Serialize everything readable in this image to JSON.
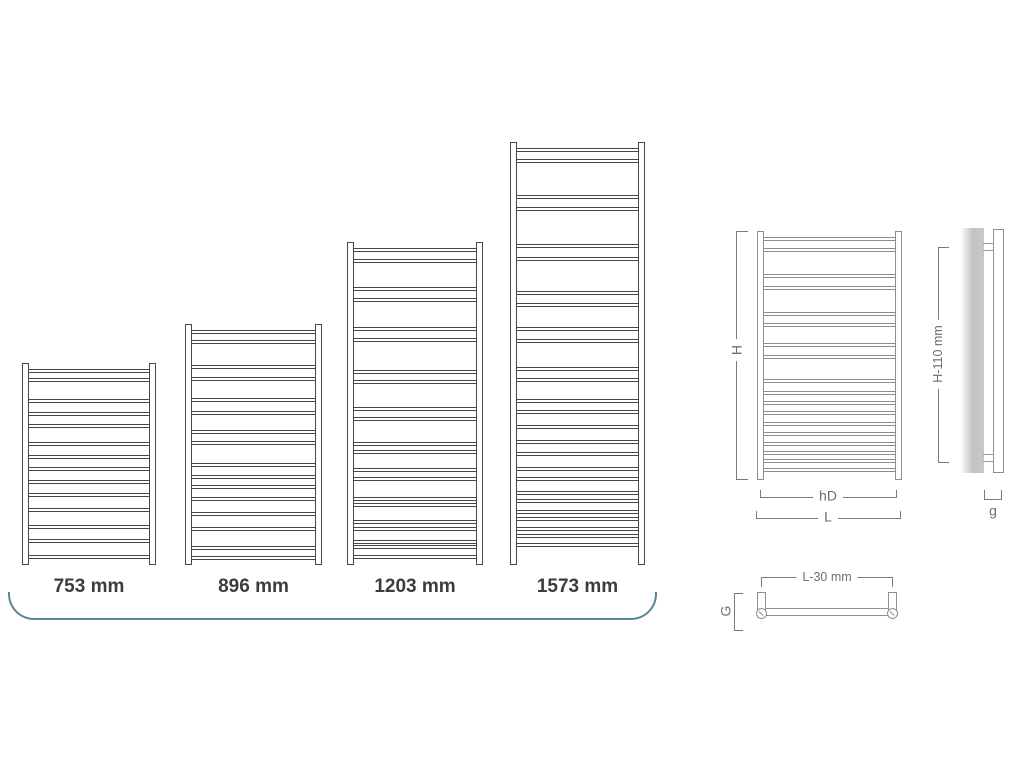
{
  "colors": {
    "radiator_line": "#474747",
    "diagram_line": "#8d8d8d",
    "dimension_line": "#7a7a7a",
    "dimension_text": "#6e6e6e",
    "size_label_text": "#3c3c3c",
    "accent_curve": "#578897",
    "wall_gray": "#c6c6c6"
  },
  "size_chart": {
    "items": [
      {
        "label": "753 mm",
        "height_mm": 753,
        "rung_positions": [
          0.03,
          0.074,
          0.178,
          0.243,
          0.302,
          0.391,
          0.455,
          0.515,
          0.579,
          0.644,
          0.718,
          0.802,
          0.871,
          0.95
        ]
      },
      {
        "label": "896 mm",
        "height_mm": 896,
        "rung_positions": [
          0.025,
          0.067,
          0.172,
          0.221,
          0.308,
          0.361,
          0.438,
          0.487,
          0.578,
          0.627,
          0.669,
          0.718,
          0.781,
          0.844,
          0.921,
          0.962
        ]
      },
      {
        "label": "1203 mm",
        "height_mm": 1203,
        "rung_positions": [
          0.02,
          0.054,
          0.138,
          0.174,
          0.262,
          0.298,
          0.396,
          0.427,
          0.51,
          0.541,
          0.618,
          0.644,
          0.7,
          0.727,
          0.788,
          0.809,
          0.861,
          0.881,
          0.922,
          0.938,
          0.968
        ]
      },
      {
        "label": "1573 mm",
        "height_mm": 1573,
        "rung_positions": [
          0.015,
          0.041,
          0.126,
          0.154,
          0.241,
          0.271,
          0.353,
          0.381,
          0.437,
          0.465,
          0.531,
          0.559,
          0.607,
          0.634,
          0.668,
          0.704,
          0.732,
          0.769,
          0.791,
          0.824,
          0.845,
          0.87,
          0.887,
          0.911,
          0.927,
          0.949
        ]
      }
    ]
  },
  "dimension_diagrams": {
    "front_view": {
      "height_label": "H",
      "hub_distance_label": "hD",
      "width_label": "L",
      "rung_positions": [
        0.023,
        0.069,
        0.174,
        0.221,
        0.324,
        0.371,
        0.451,
        0.498,
        0.594,
        0.641,
        0.683,
        0.723,
        0.768,
        0.808,
        0.848,
        0.883,
        0.917,
        0.95
      ]
    },
    "side_view": {
      "height_label": "H-110 mm",
      "wall_gap_label": "g"
    },
    "top_view": {
      "width_label": "L-30 mm",
      "depth_label": "G"
    }
  }
}
